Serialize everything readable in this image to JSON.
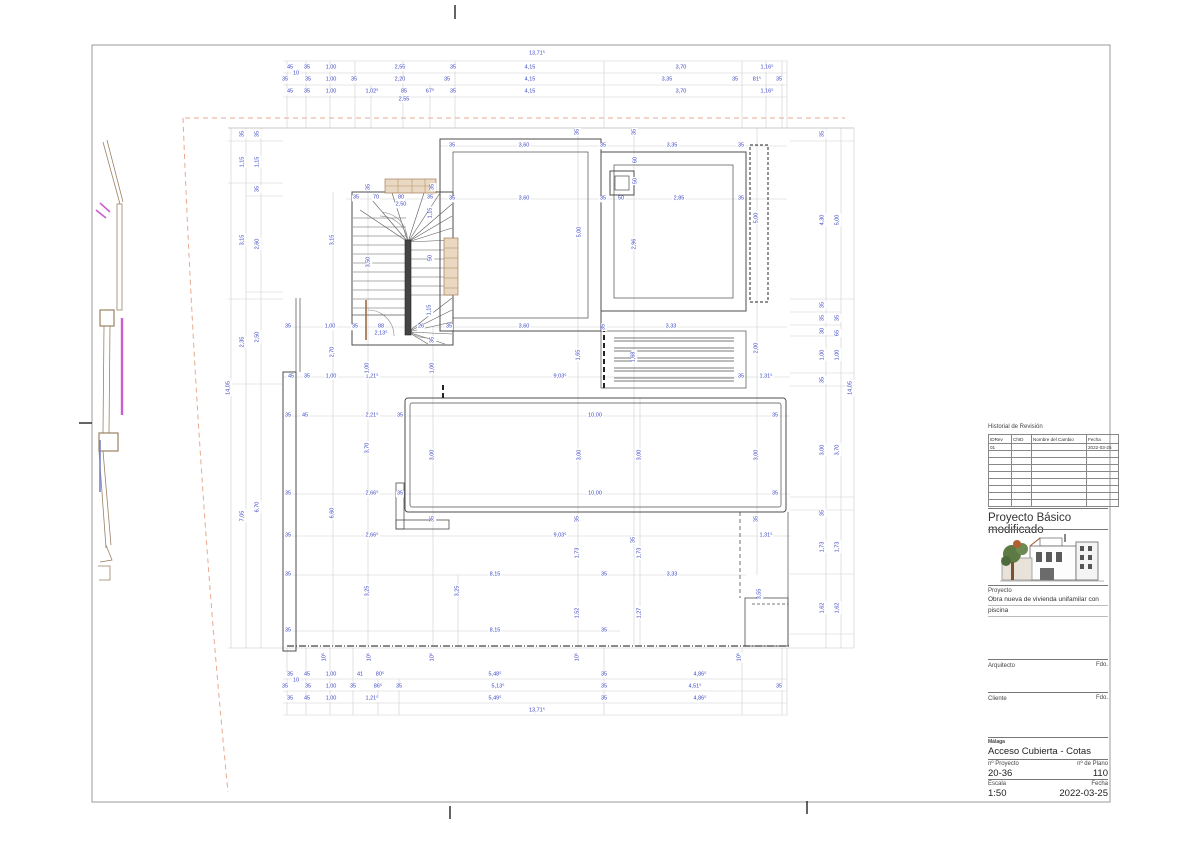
{
  "title_block": {
    "revision": {
      "title": "Historial de Revisión",
      "columns": [
        "IDRev",
        "ChID",
        "Nombre del Cambio",
        "Fecha"
      ],
      "row1": {
        "id": "01",
        "chid": "",
        "name": "",
        "date": "2022-03-25"
      }
    },
    "project_status": "Proyecto Básico modificado",
    "project_label": "Proyecto",
    "project_desc_line1": "Obra nueva de vivienda unifamilar con",
    "project_desc_line2": "piscina",
    "architect_label": "Arquitecto",
    "architect_sign": "Fdo.",
    "client_label": "Cliente",
    "client_sign": "Fdo.",
    "city": "Málaga",
    "drawing_title": "Acceso Cubierta - Cotas",
    "project_no_label": "nº Proyecto",
    "project_no": "20-36",
    "plan_no_label": "nº de Plano",
    "plan_no": "110",
    "scale_label": "Escala",
    "scale_value": "1:50",
    "date_label": "Fecha",
    "date_value": "2022-03-25"
  },
  "colors": {
    "dimension_text": "#3a46c5",
    "wall_line": "#4d4d4d",
    "chain_line": "#c9c9c9",
    "site_boundary_dashed": "#e8a98d",
    "boundary_wall": "#9b8365",
    "magenta_marker": "#c95fd0",
    "blue_marker": "#7b86c8",
    "wood_tan": "#e9d9c2"
  },
  "plan": {
    "dims_h": [
      [
        537,
        54,
        "13,71⁵"
      ],
      [
        290,
        68,
        "45"
      ],
      [
        307,
        68,
        "35"
      ],
      [
        331,
        68,
        "1,00"
      ],
      [
        400,
        68,
        "2,55"
      ],
      [
        453,
        68,
        "35"
      ],
      [
        530,
        68,
        "4,15"
      ],
      [
        681,
        68,
        "3,70"
      ],
      [
        767,
        68,
        "1,16⁵"
      ],
      [
        296,
        74,
        "10"
      ],
      [
        285,
        80,
        "35"
      ],
      [
        308,
        80,
        "35"
      ],
      [
        331,
        80,
        "1,00"
      ],
      [
        354,
        80,
        "35"
      ],
      [
        400,
        80,
        "2,20"
      ],
      [
        447,
        80,
        "35"
      ],
      [
        530,
        80,
        "4,15"
      ],
      [
        667,
        80,
        "3,35"
      ],
      [
        735,
        80,
        "35"
      ],
      [
        757,
        80,
        "81⁵"
      ],
      [
        779,
        80,
        "35"
      ],
      [
        290,
        92,
        "45"
      ],
      [
        307,
        92,
        "35"
      ],
      [
        331,
        92,
        "1,00"
      ],
      [
        372,
        92,
        "1,02⁵"
      ],
      [
        404,
        92,
        "85"
      ],
      [
        430,
        92,
        "67⁵"
      ],
      [
        453,
        92,
        "35"
      ],
      [
        530,
        92,
        "4,15"
      ],
      [
        681,
        92,
        "3,70"
      ],
      [
        767,
        92,
        "1,16⁵"
      ],
      [
        404,
        100,
        "2,55"
      ],
      [
        452,
        146,
        "35"
      ],
      [
        524,
        146,
        "3,60"
      ],
      [
        603,
        146,
        "35"
      ],
      [
        672,
        146,
        "3,35"
      ],
      [
        741,
        146,
        "35"
      ],
      [
        356,
        198,
        "35"
      ],
      [
        376,
        198,
        "70"
      ],
      [
        401,
        198,
        "80"
      ],
      [
        430,
        198,
        "35"
      ],
      [
        401,
        205,
        "2,50"
      ],
      [
        452,
        199,
        "35"
      ],
      [
        524,
        199,
        "3,60"
      ],
      [
        603,
        199,
        "35"
      ],
      [
        621,
        199,
        "50"
      ],
      [
        679,
        199,
        "2,85"
      ],
      [
        741,
        199,
        "35"
      ],
      [
        288,
        327,
        "35"
      ],
      [
        330,
        327,
        "1,00"
      ],
      [
        355,
        327,
        "35"
      ],
      [
        381,
        327,
        "88"
      ],
      [
        421,
        327,
        "26"
      ],
      [
        449,
        327,
        "35"
      ],
      [
        524,
        327,
        "3,60"
      ],
      [
        671,
        327,
        "3,33"
      ],
      [
        381,
        334,
        "2,13⁵"
      ],
      [
        291,
        377,
        "45"
      ],
      [
        307,
        377,
        "35"
      ],
      [
        331,
        377,
        "1,00"
      ],
      [
        372,
        377,
        "1,21⁵"
      ],
      [
        560,
        377,
        "9,03⁵"
      ],
      [
        741,
        377,
        "35"
      ],
      [
        766,
        377,
        "1,31⁵"
      ],
      [
        288,
        416,
        "35"
      ],
      [
        305,
        416,
        "45"
      ],
      [
        372,
        416,
        "2,21⁵"
      ],
      [
        400,
        416,
        "35"
      ],
      [
        595,
        416,
        "10,00"
      ],
      [
        775,
        416,
        "35"
      ],
      [
        288,
        494,
        "35"
      ],
      [
        372,
        494,
        "2,66⁵"
      ],
      [
        400,
        494,
        "35"
      ],
      [
        595,
        494,
        "10,00"
      ],
      [
        775,
        494,
        "35"
      ],
      [
        288,
        536,
        "35"
      ],
      [
        372,
        536,
        "2,66⁵"
      ],
      [
        560,
        536,
        "9,03⁵"
      ],
      [
        766,
        536,
        "1,31⁵"
      ],
      [
        288,
        575,
        "35"
      ],
      [
        495,
        575,
        "8,15"
      ],
      [
        604,
        575,
        "35"
      ],
      [
        672,
        575,
        "3,33"
      ],
      [
        288,
        631,
        "35"
      ],
      [
        495,
        631,
        "8,15"
      ],
      [
        604,
        631,
        "35"
      ],
      [
        290,
        675,
        "35"
      ],
      [
        307,
        675,
        "45"
      ],
      [
        331,
        675,
        "1,00"
      ],
      [
        360,
        675,
        "41"
      ],
      [
        380,
        675,
        "80⁵"
      ],
      [
        495,
        675,
        "5,48⁵"
      ],
      [
        604,
        675,
        "35"
      ],
      [
        700,
        675,
        "4,86⁵"
      ],
      [
        296,
        681,
        "10"
      ],
      [
        285,
        687,
        "35"
      ],
      [
        308,
        687,
        "35"
      ],
      [
        331,
        687,
        "1,00"
      ],
      [
        353,
        687,
        "35"
      ],
      [
        378,
        687,
        "86⁵"
      ],
      [
        399,
        687,
        "35"
      ],
      [
        498,
        687,
        "5,13⁵"
      ],
      [
        604,
        687,
        "35"
      ],
      [
        695,
        687,
        "4,51⁵"
      ],
      [
        779,
        687,
        "35"
      ],
      [
        290,
        699,
        "35"
      ],
      [
        307,
        699,
        "45"
      ],
      [
        331,
        699,
        "1,00"
      ],
      [
        372,
        699,
        "1,21⁵"
      ],
      [
        495,
        699,
        "5,49⁵"
      ],
      [
        604,
        699,
        "35"
      ],
      [
        700,
        699,
        "4,86⁵"
      ],
      [
        537,
        711,
        "13,71⁵"
      ]
    ],
    "dims_v": [
      [
        229,
        388,
        "14,05"
      ],
      [
        243,
        134,
        "35"
      ],
      [
        243,
        162,
        "1,15"
      ],
      [
        243,
        240,
        "3,15"
      ],
      [
        243,
        342,
        "2,35"
      ],
      [
        243,
        516,
        "7,05"
      ],
      [
        258,
        134,
        "35"
      ],
      [
        258,
        162,
        "1,15"
      ],
      [
        258,
        189,
        "35"
      ],
      [
        258,
        244,
        "2,60"
      ],
      [
        258,
        337,
        "2,50"
      ],
      [
        258,
        507,
        "6,70"
      ],
      [
        823,
        134,
        "35"
      ],
      [
        823,
        220,
        "4,30"
      ],
      [
        823,
        305,
        "35"
      ],
      [
        823,
        318,
        "35"
      ],
      [
        823,
        331,
        "30"
      ],
      [
        823,
        355,
        "1,00"
      ],
      [
        823,
        380,
        "35"
      ],
      [
        823,
        450,
        "3,00"
      ],
      [
        823,
        513,
        "35"
      ],
      [
        823,
        547,
        "1,73"
      ],
      [
        823,
        608,
        "1,62"
      ],
      [
        838,
        220,
        "5,00"
      ],
      [
        838,
        318,
        "35"
      ],
      [
        838,
        333,
        "65"
      ],
      [
        838,
        355,
        "1,00"
      ],
      [
        838,
        450,
        "3,70"
      ],
      [
        838,
        547,
        "1,73"
      ],
      [
        838,
        608,
        "1,62"
      ],
      [
        851,
        388,
        "14,05"
      ],
      [
        578,
        132,
        "35"
      ],
      [
        635,
        132,
        "35"
      ],
      [
        636,
        160,
        "60"
      ],
      [
        636,
        181,
        "50"
      ],
      [
        580,
        232,
        "5,00"
      ],
      [
        635,
        244,
        "2,96"
      ],
      [
        757,
        218,
        "5,00"
      ],
      [
        369,
        187,
        "35"
      ],
      [
        433,
        187,
        "35"
      ],
      [
        431,
        213,
        "1,15"
      ],
      [
        369,
        262,
        "3,50"
      ],
      [
        431,
        258,
        "50"
      ],
      [
        430,
        310,
        "1,15"
      ],
      [
        433,
        340,
        "35"
      ],
      [
        604,
        327,
        "35"
      ],
      [
        333,
        240,
        "3,15"
      ],
      [
        333,
        352,
        "2,70"
      ],
      [
        368,
        368,
        "1,00"
      ],
      [
        433,
        368,
        "1,00"
      ],
      [
        579,
        355,
        "1,65"
      ],
      [
        634,
        357,
        "1,68"
      ],
      [
        757,
        348,
        "2,00"
      ],
      [
        368,
        448,
        "3,70"
      ],
      [
        433,
        455,
        "3,00"
      ],
      [
        580,
        455,
        "3,00"
      ],
      [
        640,
        455,
        "3,00"
      ],
      [
        757,
        455,
        "3,00"
      ],
      [
        333,
        513,
        "6,60"
      ],
      [
        433,
        519,
        "35"
      ],
      [
        578,
        519,
        "35"
      ],
      [
        757,
        519,
        "35"
      ],
      [
        634,
        540,
        "35"
      ],
      [
        578,
        553,
        "1,73"
      ],
      [
        640,
        553,
        "1,73"
      ],
      [
        368,
        591,
        "3,25"
      ],
      [
        458,
        591,
        "3,25"
      ],
      [
        760,
        594,
        "3,55"
      ],
      [
        578,
        613,
        "1,52"
      ],
      [
        640,
        613,
        "1,27"
      ],
      [
        325,
        657,
        "10⁵"
      ],
      [
        370,
        657,
        "10⁵"
      ],
      [
        433,
        657,
        "10⁵"
      ],
      [
        578,
        657,
        "10⁵"
      ],
      [
        740,
        657,
        "10⁵"
      ]
    ]
  }
}
